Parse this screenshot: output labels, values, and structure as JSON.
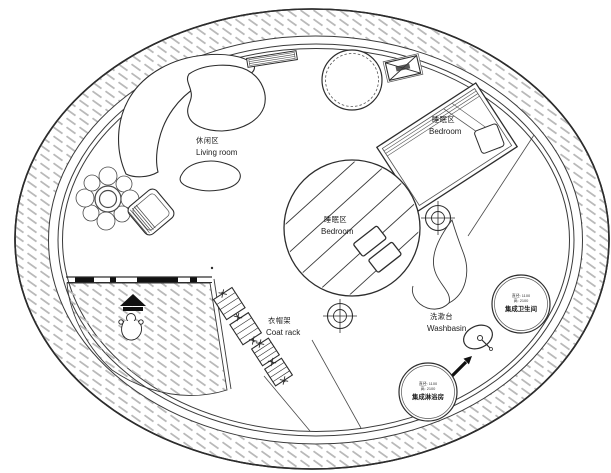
{
  "plan": {
    "areas": {
      "living_room": {
        "zh": "休闲区",
        "en": "Living room"
      },
      "bedroom_upper": {
        "zh": "睡眠区",
        "en": "Bedroom"
      },
      "bedroom_center": {
        "zh": "睡眠区",
        "en": "Bedroom"
      },
      "coat_rack": {
        "zh": "衣帽架",
        "en": "Coat rack"
      },
      "washbasin": {
        "zh": "洗漱台",
        "en": "Washbasin"
      }
    },
    "pods": {
      "bathroom": {
        "dim_diameter": "直径: 1100",
        "dim_height": "高: 2100",
        "name": "集成卫生间"
      },
      "shower": {
        "dim_diameter": "直径: 1100",
        "dim_height": "高: 2100",
        "name": "集成淋浴房"
      }
    },
    "symbols": [
      "entrance-arrow",
      "person-figure",
      "column-marker",
      "ac-unit-crossed-box",
      "plant",
      "round-table",
      "curved-sofa",
      "coffee-table",
      "armchair",
      "bed",
      "pillows",
      "coat-rack-unit",
      "washbasin-oval",
      "direction-arrow",
      "wavy-partition"
    ],
    "colors": {
      "line": "#2d2d2d",
      "hatch": "#b9b9b9",
      "background": "#ffffff",
      "door_panel": "#111111"
    }
  }
}
